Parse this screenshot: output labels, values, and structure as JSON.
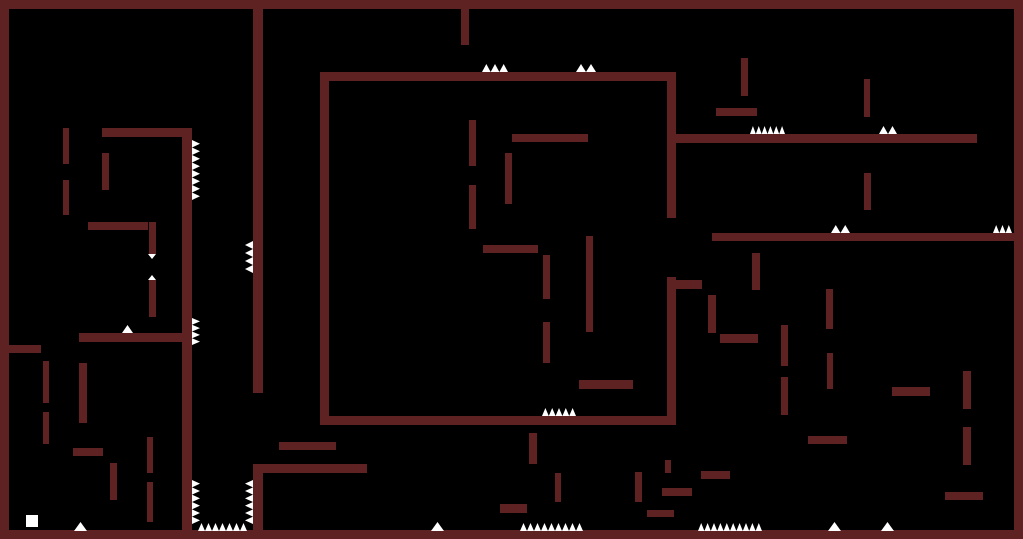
{
  "game": {
    "canvas": {
      "width": 1023,
      "height": 539
    },
    "colors": {
      "background": "#000000",
      "wall": "#5e2222",
      "hazard": "#ffffff",
      "player": "#ffffff"
    },
    "walls": [
      {
        "name": "border-top",
        "x": 0,
        "y": 0,
        "w": 1023,
        "h": 9
      },
      {
        "name": "border-bottom",
        "x": 0,
        "y": 530,
        "w": 1023,
        "h": 9
      },
      {
        "name": "border-left",
        "x": 0,
        "y": 0,
        "w": 9,
        "h": 539
      },
      {
        "name": "border-right",
        "x": 1014,
        "y": 0,
        "w": 9,
        "h": 539
      },
      {
        "name": "left-col-upper",
        "x": 63,
        "y": 128,
        "w": 6,
        "h": 36
      },
      {
        "name": "left-col-lower",
        "x": 63,
        "y": 180,
        "w": 6,
        "h": 35
      },
      {
        "name": "left-shelf-top",
        "x": 102,
        "y": 128,
        "w": 90,
        "h": 9
      },
      {
        "name": "left-col-mid",
        "x": 102,
        "y": 153,
        "w": 7,
        "h": 37
      },
      {
        "name": "left-ledge",
        "x": 88,
        "y": 222,
        "w": 60,
        "h": 8
      },
      {
        "name": "left-pin-upper",
        "x": 149,
        "y": 222,
        "w": 7,
        "h": 32
      },
      {
        "name": "left-pin-lower",
        "x": 149,
        "y": 280,
        "w": 7,
        "h": 37
      },
      {
        "name": "long-wall-left",
        "x": 182,
        "y": 128,
        "w": 10,
        "h": 411
      },
      {
        "name": "room-roof",
        "x": 79,
        "y": 333,
        "w": 104,
        "h": 9
      },
      {
        "name": "room-post",
        "x": 79,
        "y": 363,
        "w": 8,
        "h": 60
      },
      {
        "name": "left-border-stub",
        "x": 8,
        "y": 345,
        "w": 33,
        "h": 8
      },
      {
        "name": "lower-col-a",
        "x": 43,
        "y": 361,
        "w": 6,
        "h": 42
      },
      {
        "name": "lower-col-b",
        "x": 43,
        "y": 412,
        "w": 6,
        "h": 32
      },
      {
        "name": "lower-ledge",
        "x": 73,
        "y": 448,
        "w": 30,
        "h": 8
      },
      {
        "name": "lower-post",
        "x": 110,
        "y": 463,
        "w": 7,
        "h": 37
      },
      {
        "name": "lower-pin-a",
        "x": 147,
        "y": 437,
        "w": 6,
        "h": 36
      },
      {
        "name": "lower-pin-b",
        "x": 147,
        "y": 482,
        "w": 6,
        "h": 40
      },
      {
        "name": "long-wall-mid-upper",
        "x": 253,
        "y": 9,
        "w": 10,
        "h": 384
      },
      {
        "name": "long-wall-mid-lower",
        "x": 253,
        "y": 464,
        "w": 10,
        "h": 75
      },
      {
        "name": "mid-branch",
        "x": 253,
        "y": 464,
        "w": 114,
        "h": 9
      },
      {
        "name": "mid-ledge",
        "x": 279,
        "y": 442,
        "w": 57,
        "h": 8
      },
      {
        "name": "box-top",
        "x": 320,
        "y": 72,
        "w": 356,
        "h": 9
      },
      {
        "name": "box-left",
        "x": 320,
        "y": 72,
        "w": 9,
        "h": 353
      },
      {
        "name": "box-bottom",
        "x": 320,
        "y": 416,
        "w": 356,
        "h": 9
      },
      {
        "name": "box-right-upper",
        "x": 667,
        "y": 72,
        "w": 9,
        "h": 146
      },
      {
        "name": "box-right-lower",
        "x": 667,
        "y": 277,
        "w": 9,
        "h": 148
      },
      {
        "name": "box-door-lip",
        "x": 676,
        "y": 280,
        "w": 26,
        "h": 9
      },
      {
        "name": "box-pin-a",
        "x": 469,
        "y": 120,
        "w": 7,
        "h": 46
      },
      {
        "name": "box-shelf-a",
        "x": 512,
        "y": 134,
        "w": 76,
        "h": 8
      },
      {
        "name": "box-pin-b",
        "x": 505,
        "y": 153,
        "w": 7,
        "h": 51
      },
      {
        "name": "box-pin-c",
        "x": 469,
        "y": 185,
        "w": 7,
        "h": 44
      },
      {
        "name": "box-shelf-b",
        "x": 483,
        "y": 245,
        "w": 55,
        "h": 8
      },
      {
        "name": "box-pin-d",
        "x": 543,
        "y": 255,
        "w": 7,
        "h": 44
      },
      {
        "name": "box-post",
        "x": 586,
        "y": 236,
        "w": 7,
        "h": 96
      },
      {
        "name": "box-pin-e",
        "x": 543,
        "y": 322,
        "w": 7,
        "h": 41
      },
      {
        "name": "box-shelf-c",
        "x": 579,
        "y": 380,
        "w": 54,
        "h": 9
      },
      {
        "name": "top-stub",
        "x": 461,
        "y": 9,
        "w": 8,
        "h": 36
      },
      {
        "name": "right-pin-a",
        "x": 741,
        "y": 58,
        "w": 7,
        "h": 38
      },
      {
        "name": "right-shelf-a",
        "x": 716,
        "y": 108,
        "w": 41,
        "h": 8
      },
      {
        "name": "right-pin-b",
        "x": 864,
        "y": 79,
        "w": 6,
        "h": 38
      },
      {
        "name": "right-floor-upper",
        "x": 676,
        "y": 134,
        "w": 301,
        "h": 9
      },
      {
        "name": "right-pin-c",
        "x": 864,
        "y": 173,
        "w": 7,
        "h": 37
      },
      {
        "name": "right-floor-lower",
        "x": 712,
        "y": 233,
        "w": 302,
        "h": 8
      },
      {
        "name": "right-pin-d",
        "x": 752,
        "y": 253,
        "w": 8,
        "h": 37
      },
      {
        "name": "right-post-a",
        "x": 708,
        "y": 295,
        "w": 8,
        "h": 38
      },
      {
        "name": "right-ledge-a",
        "x": 720,
        "y": 334,
        "w": 38,
        "h": 9
      },
      {
        "name": "right-pin-e",
        "x": 781,
        "y": 325,
        "w": 7,
        "h": 41
      },
      {
        "name": "right-pin-f",
        "x": 781,
        "y": 377,
        "w": 7,
        "h": 38
      },
      {
        "name": "right-pin-g",
        "x": 826,
        "y": 289,
        "w": 7,
        "h": 40
      },
      {
        "name": "right-pin-h",
        "x": 827,
        "y": 353,
        "w": 6,
        "h": 36
      },
      {
        "name": "right-ledge-b",
        "x": 892,
        "y": 387,
        "w": 38,
        "h": 9
      },
      {
        "name": "right-pin-i",
        "x": 963,
        "y": 371,
        "w": 8,
        "h": 38
      },
      {
        "name": "right-pin-j",
        "x": 963,
        "y": 427,
        "w": 8,
        "h": 38
      },
      {
        "name": "right-ledge-c",
        "x": 808,
        "y": 436,
        "w": 39,
        "h": 8
      },
      {
        "name": "right-ledge-d",
        "x": 701,
        "y": 471,
        "w": 29,
        "h": 8
      },
      {
        "name": "right-ledge-e",
        "x": 662,
        "y": 488,
        "w": 30,
        "h": 8
      },
      {
        "name": "right-ledge-f",
        "x": 647,
        "y": 510,
        "w": 27,
        "h": 7
      },
      {
        "name": "right-ledge-g",
        "x": 945,
        "y": 492,
        "w": 38,
        "h": 8
      },
      {
        "name": "right-pin-k",
        "x": 665,
        "y": 460,
        "w": 6,
        "h": 13
      },
      {
        "name": "right-pin-l",
        "x": 635,
        "y": 472,
        "w": 7,
        "h": 30
      },
      {
        "name": "under-box-pin-a",
        "x": 529,
        "y": 433,
        "w": 8,
        "h": 31
      },
      {
        "name": "under-box-pin-b",
        "x": 555,
        "y": 473,
        "w": 6,
        "h": 29
      },
      {
        "name": "under-box-ledge",
        "x": 500,
        "y": 504,
        "w": 27,
        "h": 9
      }
    ],
    "spikes": [
      {
        "name": "box-top-spikes-a",
        "dir": "up",
        "x": 482,
        "y": 64,
        "len": 26,
        "depth": 8,
        "count": 3
      },
      {
        "name": "box-top-spikes-b",
        "dir": "up",
        "x": 576,
        "y": 64,
        "len": 20,
        "depth": 8,
        "count": 2
      },
      {
        "name": "upper-floor-spikes-a",
        "dir": "up",
        "x": 750,
        "y": 126,
        "len": 35,
        "depth": 8,
        "count": 6
      },
      {
        "name": "upper-floor-spikes-b",
        "dir": "up",
        "x": 879,
        "y": 126,
        "len": 18,
        "depth": 8,
        "count": 2
      },
      {
        "name": "mid-floor-spikes-a",
        "dir": "up",
        "x": 831,
        "y": 225,
        "len": 19,
        "depth": 8,
        "count": 2
      },
      {
        "name": "mid-floor-spikes-b",
        "dir": "up",
        "x": 993,
        "y": 225,
        "len": 19,
        "depth": 8,
        "count": 3
      },
      {
        "name": "box-bottom-spikes",
        "dir": "up",
        "x": 542,
        "y": 408,
        "len": 34,
        "depth": 8,
        "count": 5
      },
      {
        "name": "ground-spike-a",
        "dir": "up",
        "x": 74,
        "y": 522,
        "len": 13,
        "depth": 9,
        "count": 1
      },
      {
        "name": "pit-floor-spikes",
        "dir": "up",
        "x": 198,
        "y": 523,
        "len": 49,
        "depth": 8,
        "count": 7
      },
      {
        "name": "ground-spike-b",
        "dir": "up",
        "x": 431,
        "y": 522,
        "len": 13,
        "depth": 9,
        "count": 1
      },
      {
        "name": "ground-spikes-c",
        "dir": "up",
        "x": 520,
        "y": 523,
        "len": 63,
        "depth": 8,
        "count": 9
      },
      {
        "name": "ground-spikes-d",
        "dir": "up",
        "x": 698,
        "y": 523,
        "len": 64,
        "depth": 8,
        "count": 10
      },
      {
        "name": "ground-spike-e",
        "dir": "up",
        "x": 828,
        "y": 522,
        "len": 13,
        "depth": 9,
        "count": 1
      },
      {
        "name": "ground-spike-f",
        "dir": "up",
        "x": 881,
        "y": 522,
        "len": 13,
        "depth": 9,
        "count": 1
      },
      {
        "name": "roof-spike",
        "dir": "up",
        "x": 122,
        "y": 325,
        "len": 11,
        "depth": 8,
        "count": 1
      },
      {
        "name": "pin-gap-spike-up",
        "dir": "up",
        "x": 148,
        "y": 275,
        "len": 8,
        "depth": 5,
        "count": 1
      },
      {
        "name": "pin-gap-spike-down",
        "dir": "down",
        "x": 148,
        "y": 254,
        "len": 8,
        "depth": 5,
        "count": 1
      },
      {
        "name": "wall-spikes-right-a",
        "dir": "right",
        "x": 192,
        "y": 140,
        "len": 60,
        "depth": 8,
        "count": 8
      },
      {
        "name": "wall-spikes-right-b",
        "dir": "right",
        "x": 192,
        "y": 318,
        "len": 27,
        "depth": 8,
        "count": 4
      },
      {
        "name": "pit-left-wall-spikes",
        "dir": "right",
        "x": 192,
        "y": 480,
        "len": 44,
        "depth": 8,
        "count": 6
      },
      {
        "name": "wall-spikes-left-a",
        "dir": "left",
        "x": 245,
        "y": 241,
        "len": 32,
        "depth": 8,
        "count": 4
      },
      {
        "name": "pit-right-wall-spikes",
        "dir": "left",
        "x": 245,
        "y": 480,
        "len": 44,
        "depth": 8,
        "count": 6
      }
    ],
    "player": {
      "x": 26,
      "y": 515,
      "w": 12,
      "h": 12
    }
  }
}
